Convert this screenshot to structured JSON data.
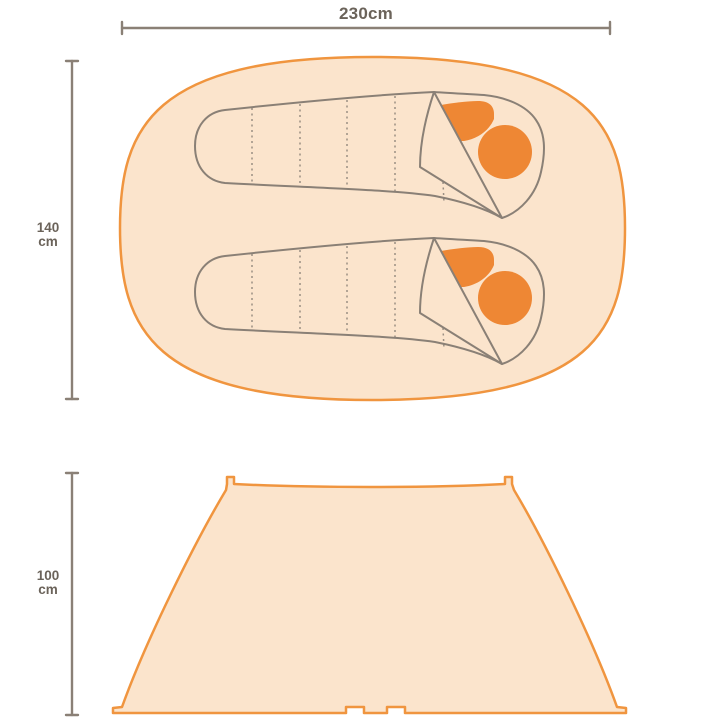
{
  "colors": {
    "background": "#ffffff",
    "tent-fill": "#FBE4CC",
    "tent-stroke": "#F0953F",
    "accent-orange": "#EE8734",
    "line-gray": "#8A8076",
    "text-gray": "#6B635A"
  },
  "diagram": {
    "top_view": {
      "width_dimension": {
        "label": "230cm",
        "value_cm": 230
      },
      "depth_dimension": {
        "value": "140",
        "unit": "cm",
        "value_cm": 140
      },
      "sleeping_bag_count": 2
    },
    "side_view": {
      "height_dimension": {
        "value": "100",
        "unit": "cm",
        "value_cm": 100
      }
    }
  }
}
